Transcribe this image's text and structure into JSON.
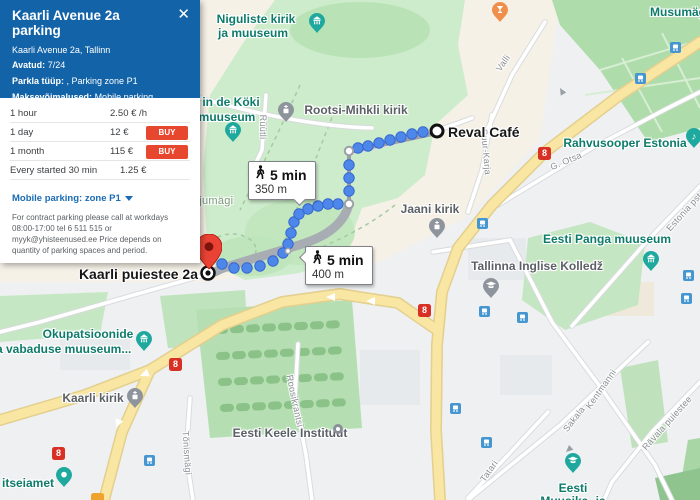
{
  "panel": {
    "title": "Kaarli Avenue 2a parking",
    "close_icon": "✕",
    "address": "Kaarli Avenue 2a, Tallinn",
    "fields": [
      {
        "label": "Avatud:",
        "value": "7/24"
      },
      {
        "label": "Parkla tüüp:",
        "value": ", Parking zone P1"
      },
      {
        "label": "Maksevõimalused:",
        "value": "Mobile parking, Parking machine payments"
      }
    ],
    "tariffs": [
      {
        "label": "1 hour",
        "price": "2.50 € /h",
        "buy": ""
      },
      {
        "label": "1 day",
        "price": "12 €",
        "buy": "BUY"
      },
      {
        "label": "1 month",
        "price": "115 €",
        "buy": "BUY"
      },
      {
        "label": "Every started 30 min",
        "price": "1.25 €",
        "buy": ""
      }
    ],
    "mobile_heading": "Mobile parking: zone P1",
    "mobile_note": "For contract parking please call at workdays 08:00-17:00 tel 6 511 515 or myyk@yhisteenused.ee Price depends on quantity of parking spaces and period."
  },
  "route": {
    "start": "Reval Café",
    "destination": "Kaarli puiestee 2a",
    "walk1_time": "5 min",
    "walk1_dist": "350 m",
    "walk2_time": "5 min",
    "walk2_dist": "400 m"
  },
  "pois": {
    "niguliste_l1": "Niguliste kirik",
    "niguliste_l2": "ja muuseum",
    "kok_l1": "in de Köki",
    "kok_l2": "muuseum",
    "rootsi": "Rootsi-Mihkli kirik",
    "musumagi": "Musumägi",
    "rahvusooper": "Rahvusooper Estonia",
    "jaani": "Jaani kirik",
    "panga": "Eesti Panga muuseum",
    "inglise": "Tallinna Inglise Kolledž",
    "okup_l1": "Okupatsioonide",
    "okup_l2": "ja vabaduse muuseum...",
    "kaarli_kirik": "Kaarli kirik",
    "itseiamet": "itseiamet",
    "keele": "Eesti Keele Instituut",
    "muusika_l1": "Eesti",
    "muusika_l2": "Muusika- ja"
  },
  "streets": {
    "ruutli": "Rüütli",
    "valli": "Valli",
    "suurkarja": "Suur-Karja",
    "gotsa": "G. Otsa",
    "harjumagi": "Harjumägi",
    "tonismagi": "Tõnismägi",
    "roosikrantsi": "Roosikrantsi",
    "sakala": "Sakala",
    "kentmanni": "Kentmanni",
    "ravala": "Rävala puiestee",
    "tatari": "Tatari",
    "estonia": "Estonia pst"
  },
  "shield_number": "8",
  "colors": {
    "panel_blue": "#1263a8",
    "buy_red": "#e8472f",
    "poi_teal": "#0e7b6a",
    "route_blue": "#4d87ea",
    "road_yellow": "#f8e6a2",
    "marker_red": "#ea4335"
  }
}
